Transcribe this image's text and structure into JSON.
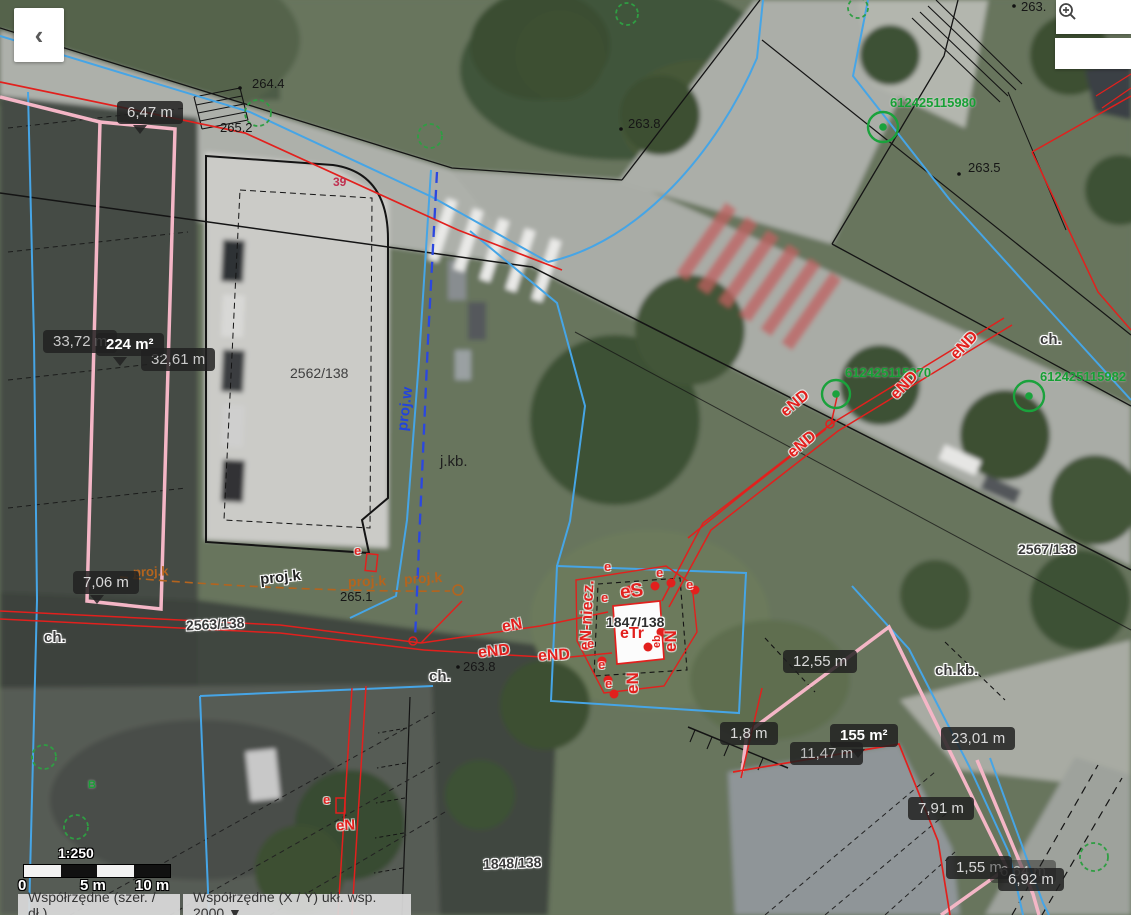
{
  "controls": {
    "back": "‹"
  },
  "statusbar": {
    "geo": "Współrzędne (szer. / dł.)",
    "xy": "Współrzędne (X / Y) ukł. wsp. 2000 ▼"
  },
  "scalebar": {
    "ratio": "1:250",
    "t0": "0",
    "t1": "5 m",
    "t2": "10 m"
  },
  "measure": {
    "m647": "6,47 m",
    "m3372": "33,72 m",
    "a224": "224 m²",
    "m3261": "32,61 m",
    "m706": "7,06 m",
    "m1255": "12,55 m",
    "m18": "1,8 m",
    "m1147": "11,47 m",
    "a155": "155 m²",
    "m2301": "23,01 m",
    "m791": "7,91 m",
    "m155": "1,55 m",
    "m664": "6,64 m",
    "m692": "6,92 m"
  },
  "parcel": {
    "p2562": "2562/138",
    "p2563": "2563/138",
    "p2567": "2567/138",
    "p1847": "1847/138",
    "p1848": "1848/138"
  },
  "surface": {
    "jkb": "j.kb.",
    "ch": "ch.",
    "chkb": "ch.kb."
  },
  "elev": {
    "e1": "264.4",
    "e2": "265.2",
    "e3": "263.8",
    "e4": "263.5",
    "e5": "265.1",
    "e6": "263.8",
    "e7": "263."
  },
  "gid": {
    "g1": "612425115980",
    "g2": "612425115970",
    "g3": "612425115982",
    "b": "B"
  },
  "code": {
    "eS": "eS",
    "eTr": "eTr",
    "eNniecz": "eN-niecz.",
    "eN": "eN",
    "eND": "eND",
    "e": "e",
    "eb": "eb",
    "n39": "39",
    "projw": "proj.w",
    "projk": "proj.k"
  }
}
